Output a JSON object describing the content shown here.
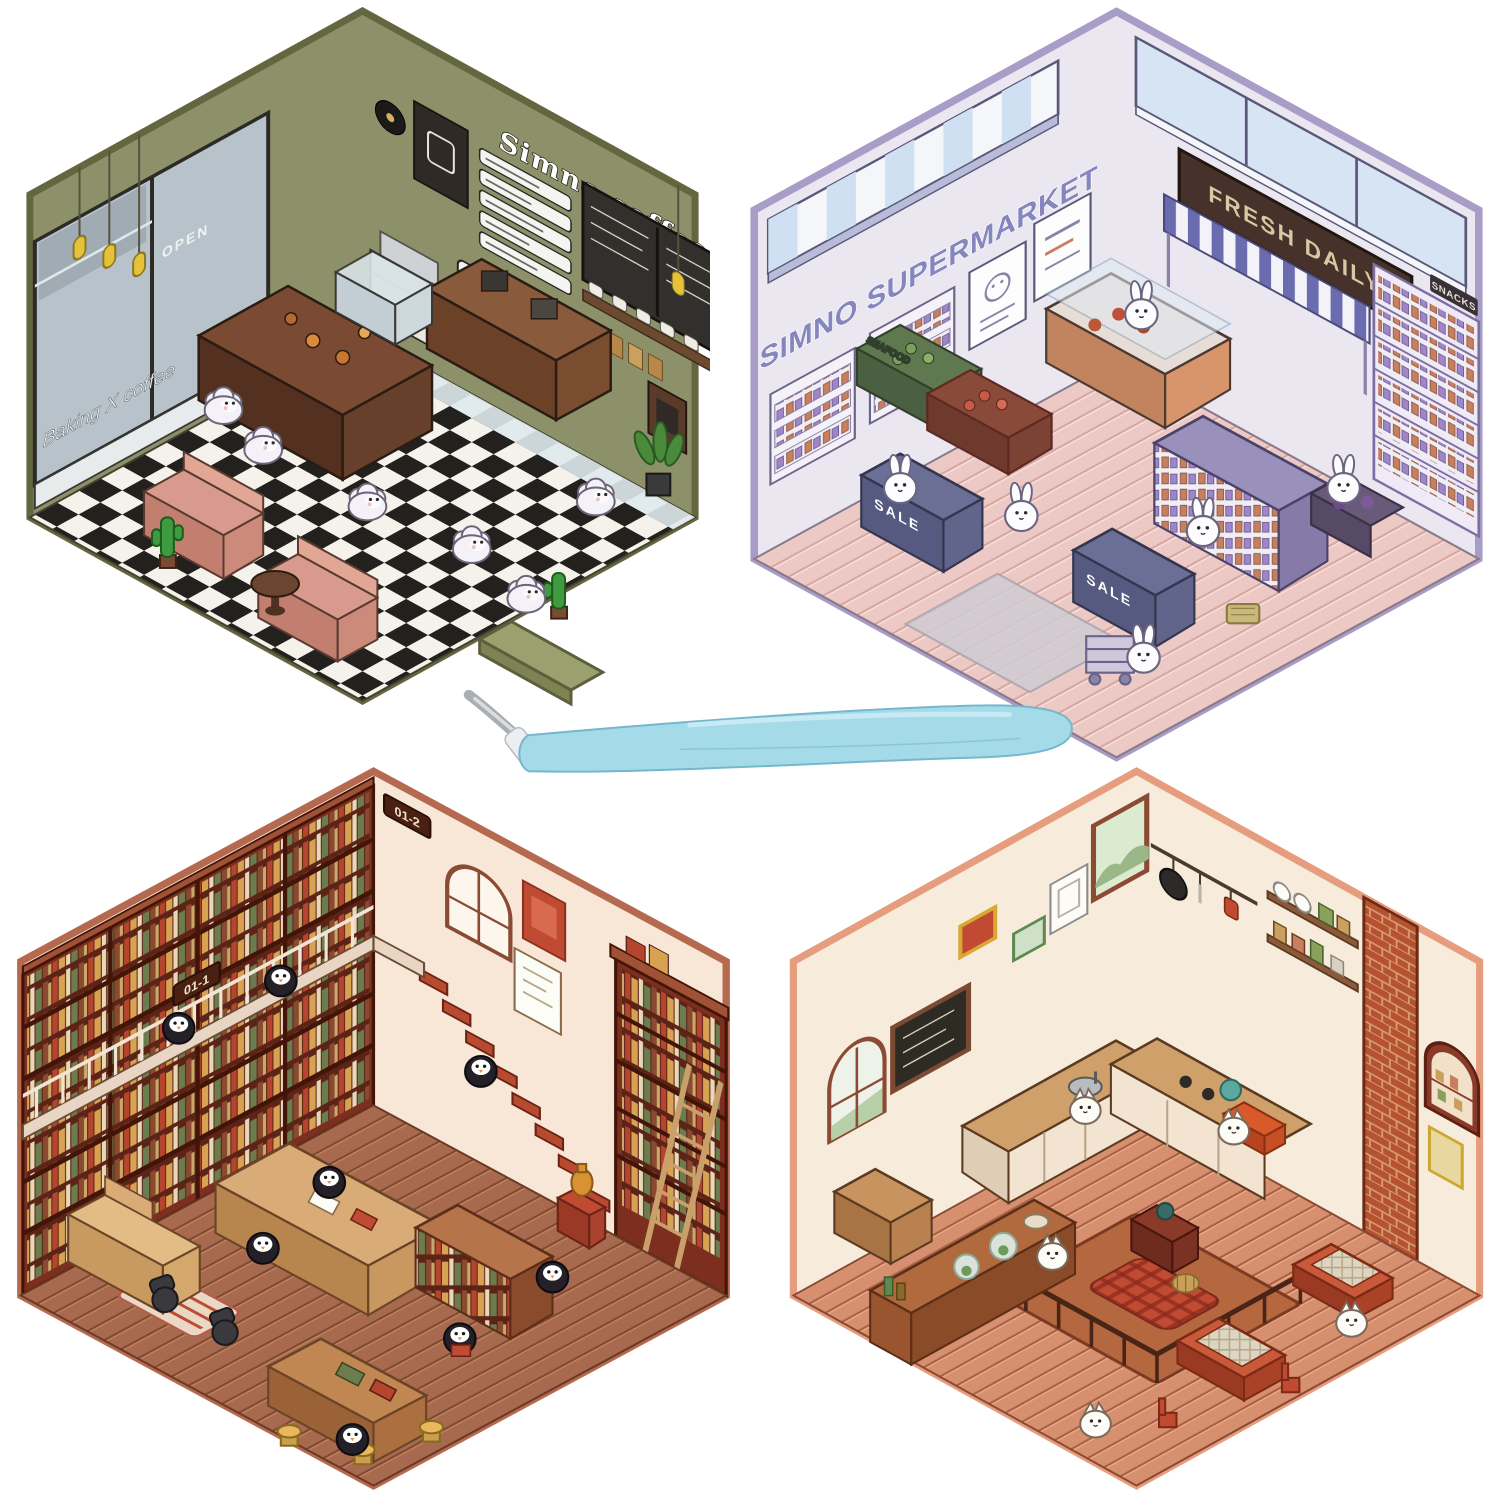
{
  "page": {
    "background_color": "#ffffff"
  },
  "scenes": {
    "coffee_shop": {
      "title": "Simno coffee",
      "window_sign": "Baking X coffee",
      "door_sign": "OPEN",
      "wall_sign": "Coffee",
      "colors": {
        "wall": "#8d9169",
        "frame": "#63663f",
        "floor_light": "#f5f2ec",
        "floor_dark": "#23211e",
        "counter": "#7a4a33",
        "booth": "#d89a8c",
        "lamp": "#e6c23a"
      },
      "characters": "fluffy-sheep"
    },
    "supermarket": {
      "title": "SIMNO SUPERMARKET",
      "awning_sign": "FRESH DAILY",
      "produce_sign": "SEAFOOD",
      "checkout_sign": "SALE",
      "shelf_sign": "SNACKS",
      "colors": {
        "wall": "#eae7f1",
        "frame": "#a79dc6",
        "floor": "#ecc9c5",
        "sign_board": "#46322a",
        "sign_text": "#d8c8a4",
        "awning_stripe": "#6b6bb0",
        "checkout": "#6b6f96"
      },
      "characters": "white-rabbits"
    },
    "library": {
      "loft_sign_left": "01-1",
      "loft_sign_right": "01-2",
      "colors": {
        "wall": "#f8e6d6",
        "frame": "#b56a50",
        "bookshelf": "#7c2f1f",
        "floor": "#a86a4e",
        "stairs": "#b84a30",
        "desk": "#d8ab77"
      },
      "characters": "penguins"
    },
    "kitchen": {
      "colors": {
        "wall": "#f7ecdc",
        "frame": "#e69d7e",
        "floor": "#d68f6f",
        "brick": "#b5532e",
        "counter": "#cfa06a",
        "cabinet": "#f2e4d0",
        "table": "#c85a3a"
      },
      "characters": "white-cats"
    }
  },
  "tool": {
    "name": "tweezers",
    "handle_color": "#a5dbe9",
    "tip_color": "#a8aeb2"
  }
}
